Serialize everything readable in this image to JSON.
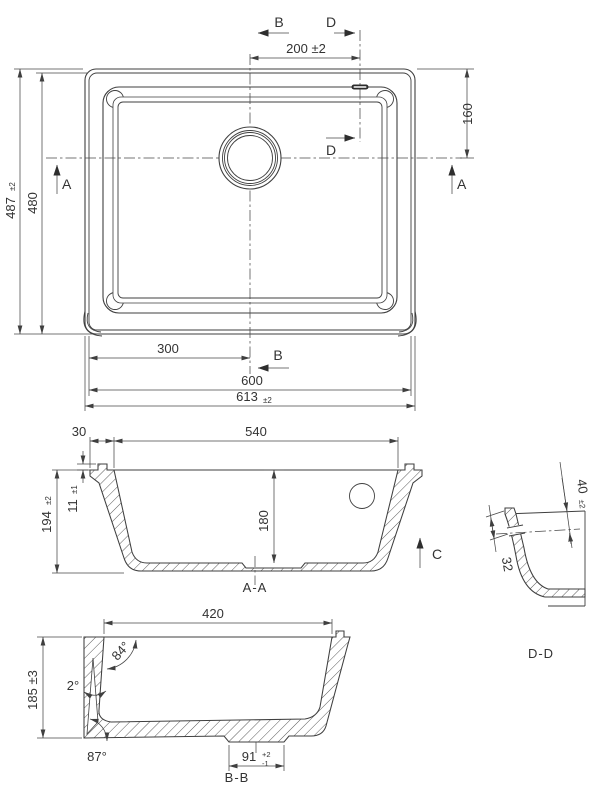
{
  "drawing": {
    "top_view": {
      "section_a": "A",
      "section_b": "B",
      "section_d": "D",
      "dim_drain_offset_x": "200 ±2",
      "dim_drain_offset_y": "160",
      "dim_height_overall": "487",
      "dim_height_overall_tol": "±2",
      "dim_height_body": "480",
      "dim_width_half": "300",
      "dim_width_body": "600",
      "dim_width_overall": "613",
      "dim_width_overall_tol": "±2"
    },
    "section_aa": {
      "label": "A-A",
      "dim_flange": "30",
      "dim_bowl_width": "540",
      "dim_height": "194",
      "dim_height_tol": "±2",
      "dim_lip_height": "11",
      "dim_lip_height_tol": "±1",
      "dim_bowl_depth": "180",
      "view_c": "C"
    },
    "section_bb": {
      "label": "B-B",
      "dim_bowl_width": "420",
      "dim_height": "185 ±3",
      "angle_wall": "84°",
      "angle_draft": "2°",
      "angle_corner": "87°",
      "dim_recess": "91",
      "dim_recess_tol_plus": "+2",
      "dim_recess_tol_minus": "-1"
    },
    "detail_dd": {
      "label": "D-D",
      "dim_overflow_depth": "40",
      "dim_overflow_depth_tol": "±2",
      "dim_slot": "32"
    }
  }
}
